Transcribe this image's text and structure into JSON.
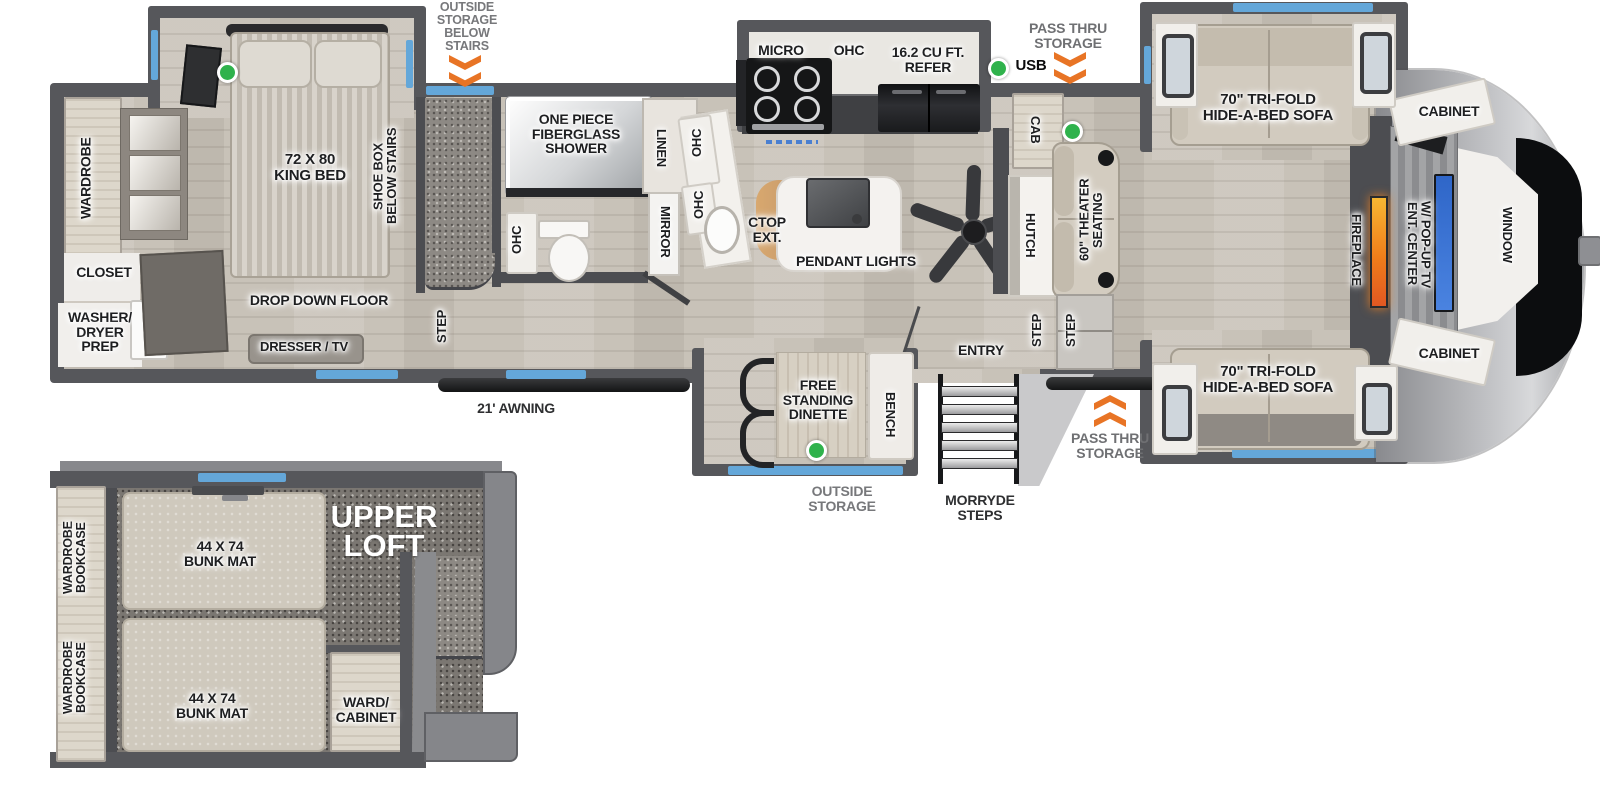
{
  "colors": {
    "wall": "#56575b",
    "accent_blue": "#64a7d9",
    "accent_orange": "#e87425",
    "accent_green": "#2fb24c",
    "fireplace_glow": "#ef7d1a",
    "tv_blue": "#3a6fd8",
    "floor_wood": "#c8c2b8",
    "carpet": "#8d8984"
  },
  "exterior": {
    "outside_storage_below_stairs": "OUTSIDE\nSTORAGE\nBELOW\nSTAIRS",
    "pass_thru_storage_top": "PASS THRU\nSTORAGE",
    "pass_thru_storage_bottom": "PASS THRU\nSTORAGE",
    "outside_storage_bottom": "OUTSIDE\nSTORAGE",
    "awning": "21' AWNING",
    "morryde_steps": "MORRYDE\nSTEPS",
    "usb": "USB",
    "entry": "ENTRY"
  },
  "bedroom": {
    "wardrobe": "WARDROBE",
    "king_bed": "72 X 80\nKING BED",
    "shoe_box": "SHOE BOX\nBELOW STAIRS",
    "closet": "CLOSET",
    "washer_dryer": "WASHER/\nDRYER\nPREP",
    "drop_down_floor": "DROP DOWN FLOOR",
    "dresser_tv": "DRESSER / TV",
    "step": "STEP"
  },
  "bathroom": {
    "shower": "ONE PIECE\nFIBERGLASS\nSHOWER",
    "linen": "LINEN",
    "ohc_top": "OHC",
    "ohc_mid": "OHC",
    "mirror": "MIRROR",
    "ohc_toilet": "OHC"
  },
  "kitchen": {
    "micro": "MICRO",
    "ohc": "OHC",
    "refer": "16.2 CU FT.\nREFER",
    "ctop_ext": "CTOP\nEXT.",
    "pendant_lights": "PENDANT LIGHTS",
    "cab": "CAB",
    "hutch": "HUTCH"
  },
  "living": {
    "sofa_top": "70\" TRI-FOLD\nHIDE-A-BED SOFA",
    "sofa_bottom": "70\" TRI-FOLD\nHIDE-A-BED SOFA",
    "cabinet_top": "CABINET",
    "cabinet_bottom": "CABINET",
    "theater_seating": "60\" THEATER\nSEATING",
    "fireplace": "FIREPLACE",
    "ent_center": "ENT. CENTER\nW/ POP-UP TV",
    "window": "WINDOW"
  },
  "entry_area": {
    "step1": "STEP",
    "step2": "STEP"
  },
  "dinette": {
    "free_standing_dinette": "FREE\nSTANDING\nDINETTE",
    "bench": "BENCH"
  },
  "loft": {
    "title": "UPPER\nLOFT",
    "bunk1": "44 X 74\nBUNK MAT",
    "bunk2": "44 X 74\nBUNK MAT",
    "ward_cabinet": "WARD/\nCABINET",
    "wardrobe_bookcase1": "WARDROBE\nBOOKCASE",
    "wardrobe_bookcase2": "WARDROBE\nBOOKCASE"
  }
}
